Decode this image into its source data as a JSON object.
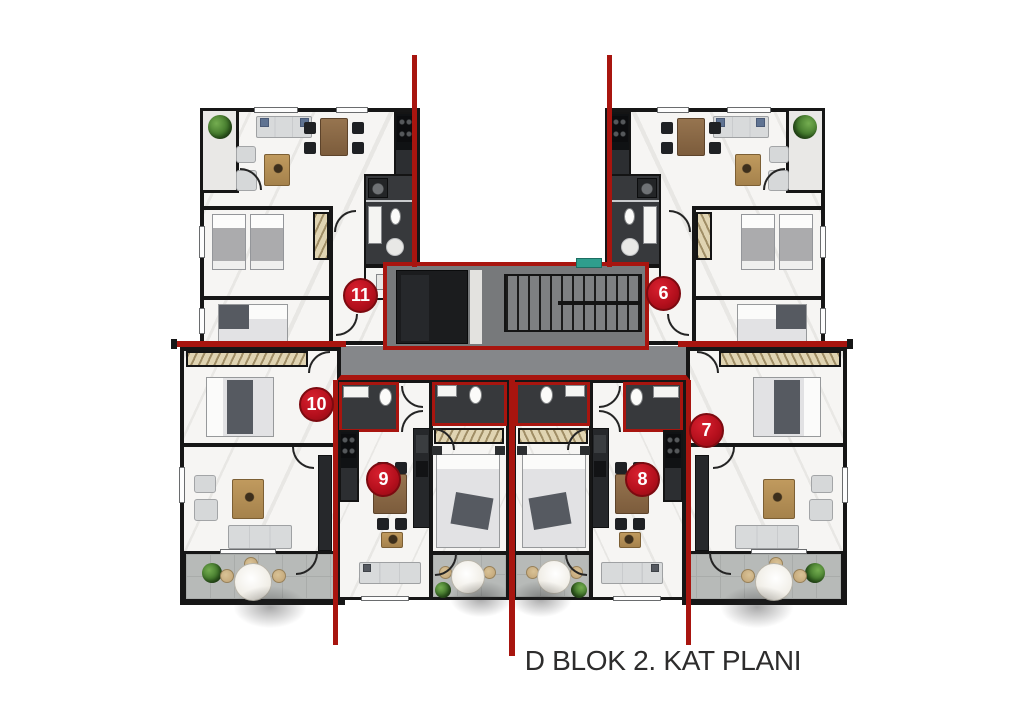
{
  "title": "D BLOK 2. KAT PLANI",
  "markers": [
    {
      "number": "11"
    },
    {
      "number": "6"
    },
    {
      "number": "10"
    },
    {
      "number": "7"
    },
    {
      "number": "9"
    },
    {
      "number": "8"
    }
  ],
  "colors": {
    "section_line_red": "#a8150f",
    "marker_red": "#b30f1c",
    "wall_black": "#161616",
    "marble_floor": "#f6f5f3",
    "wet_area_dark": "#37393c",
    "core_gray": "#77797b",
    "corridor_gray": "#85878a",
    "elevator_dark": "#1b1c1e",
    "balcony_gray": "#b7bab8",
    "wardrobe_beige": "#e0d4b2",
    "wood_brown": "#8a674a",
    "plant_green": "#3c7227",
    "exit_sign_teal": "#2f9e8d",
    "title_text": "#2d2c2c"
  }
}
